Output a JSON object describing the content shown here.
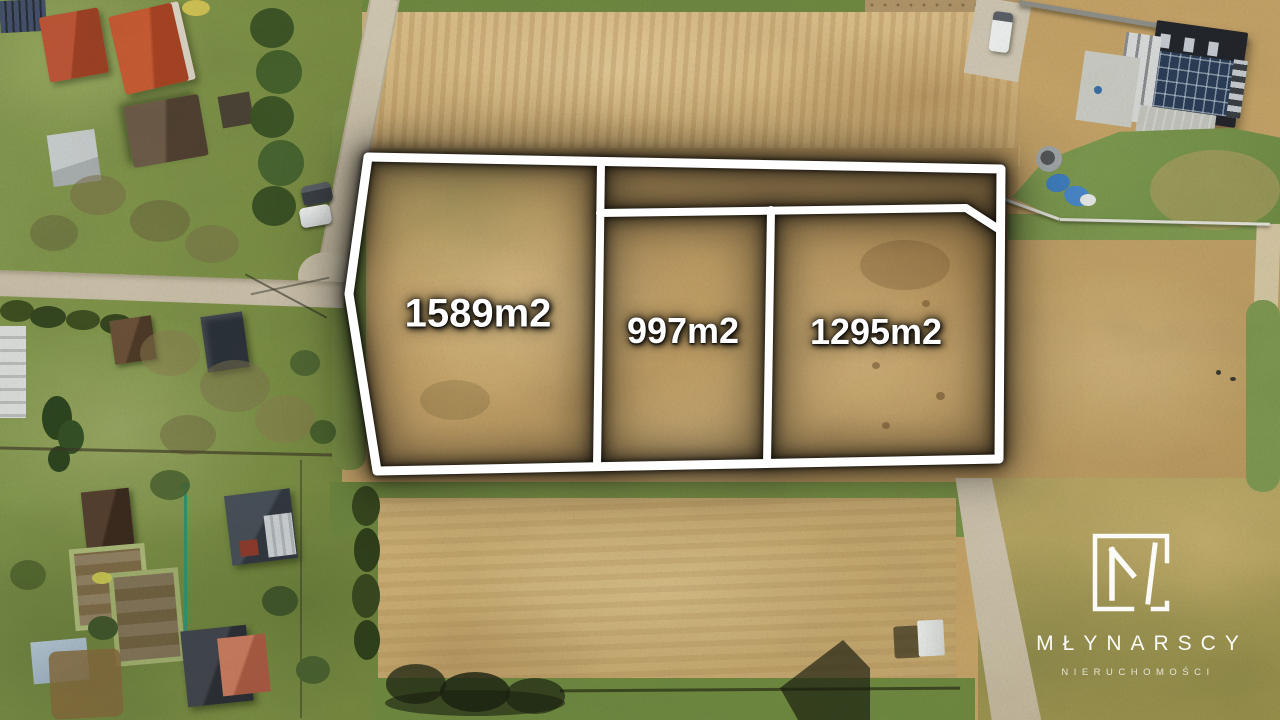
{
  "overlay": {
    "outline_color": "#ffffff",
    "glow_color": "#000000",
    "plots": [
      {
        "area": "1589m2"
      },
      {
        "area": "997m2"
      },
      {
        "area": "1295m2"
      }
    ]
  },
  "logo": {
    "monogram": "M",
    "name": "MŁYNARSCY",
    "subtitle": "NIERUCHOMOŚCI",
    "color": "#ffffff"
  },
  "palette": {
    "field_tan": "#c6a468",
    "field_straw": "#dcc08a",
    "field_bottom": "#cfb277",
    "field_olive": "#b3a262",
    "lawn_green": "#7d944c",
    "hedge_green": "#3c5524",
    "road_gray": "#cfc5ae",
    "roof_red": "#c05936",
    "roof_dark": "#23262c",
    "solar_blue": "#2a3e57"
  }
}
